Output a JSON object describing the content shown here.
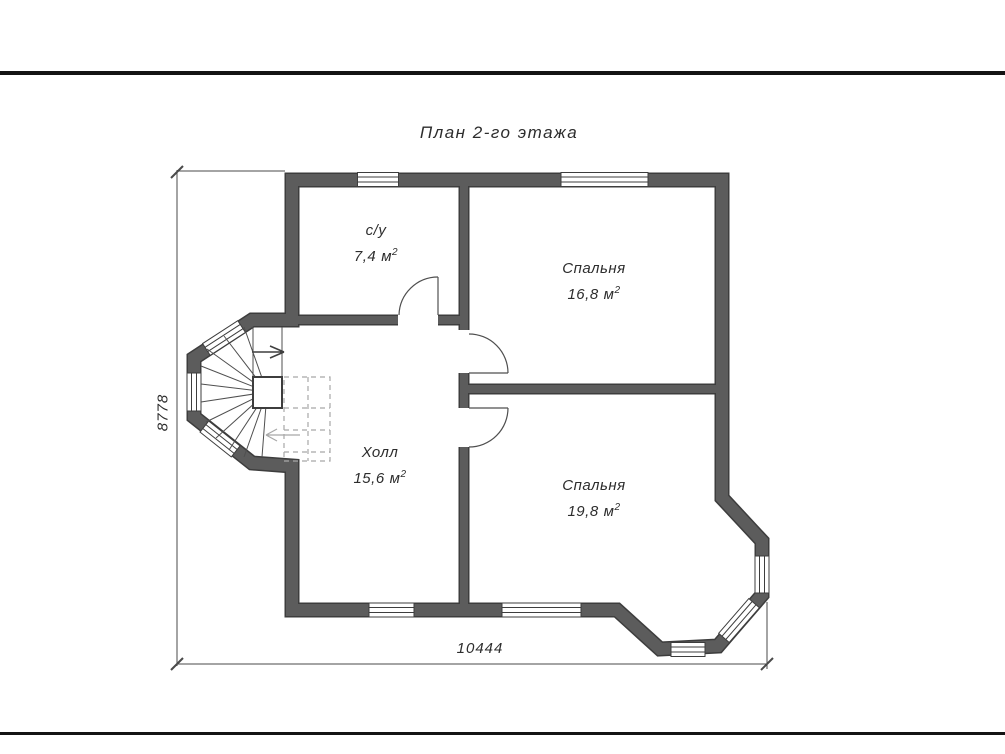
{
  "title": "План 2-го этажа",
  "rooms": [
    {
      "id": "bathroom",
      "name": "с/у",
      "area_value": "7,4",
      "area_unit": "м",
      "area_sup": "2"
    },
    {
      "id": "bedroom-1",
      "name": "Спальня",
      "area_value": "16,8",
      "area_unit": "м",
      "area_sup": "2"
    },
    {
      "id": "hall",
      "name": "Холл",
      "area_value": "15,6",
      "area_unit": "м",
      "area_sup": "2"
    },
    {
      "id": "bedroom-2",
      "name": "Спальня",
      "area_value": "19,8",
      "area_unit": "м",
      "area_sup": "2"
    }
  ],
  "dimensions": {
    "width": "10444",
    "height": "8778"
  },
  "colors": {
    "background": "#ffffff",
    "wall_fill": "#5c5c5c",
    "wall_edge": "#3d3d3d",
    "line": "#4a4a4a",
    "hidden_line": "#a8a8a8",
    "text": "#2d2d2d",
    "frame_rule": "#141414"
  }
}
